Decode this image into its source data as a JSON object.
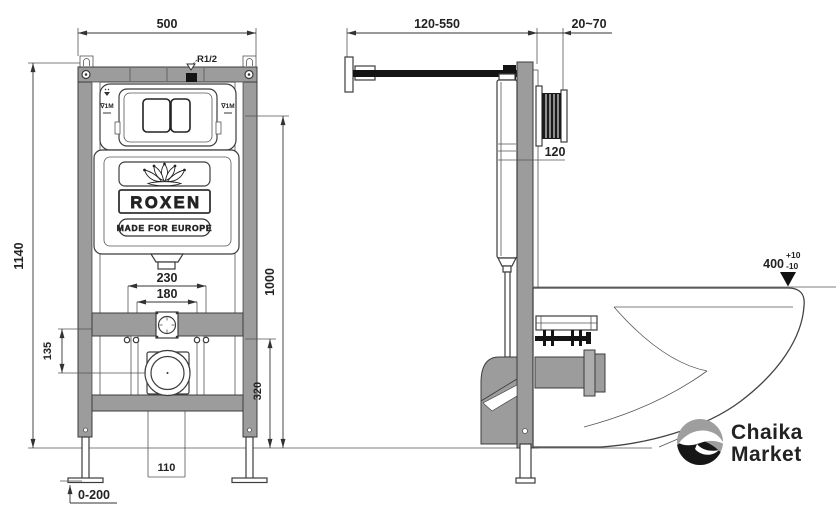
{
  "front_view": {
    "dim_width_top": "500",
    "dim_height_overall": "1140",
    "dim_holes_outer": "230",
    "dim_holes_inner": "180",
    "dim_height_right": "1000",
    "dim_bracket_offset": "135",
    "dim_outlet_height": "320",
    "dim_outlet_width": "110",
    "dim_leg_adjust": "0-200",
    "inlet_thread_label": "R1/2",
    "level_mark_left": "∇1M",
    "level_mark_right": "∇1M",
    "tank_brand": "ROXEN",
    "tank_tagline": "MADE FOR EUROPE"
  },
  "side_view": {
    "dim_pipe_extension": "120-550",
    "dim_wall_thickness": "20~70",
    "dim_frame_depth": "120",
    "dim_bowl_height": "400",
    "dim_bowl_tol_plus": "+10",
    "dim_bowl_tol_minus": "-10"
  },
  "watermark": {
    "brand_line1": "Chaika",
    "brand_line2": "Market"
  },
  "colors": {
    "steel": "#9c9c9c",
    "line_dark": "#3c3c3c",
    "black": "#141414",
    "logo_gray": "#9e9e9e",
    "logo_black": "#161616",
    "logo_text": "#2b2b2b"
  }
}
